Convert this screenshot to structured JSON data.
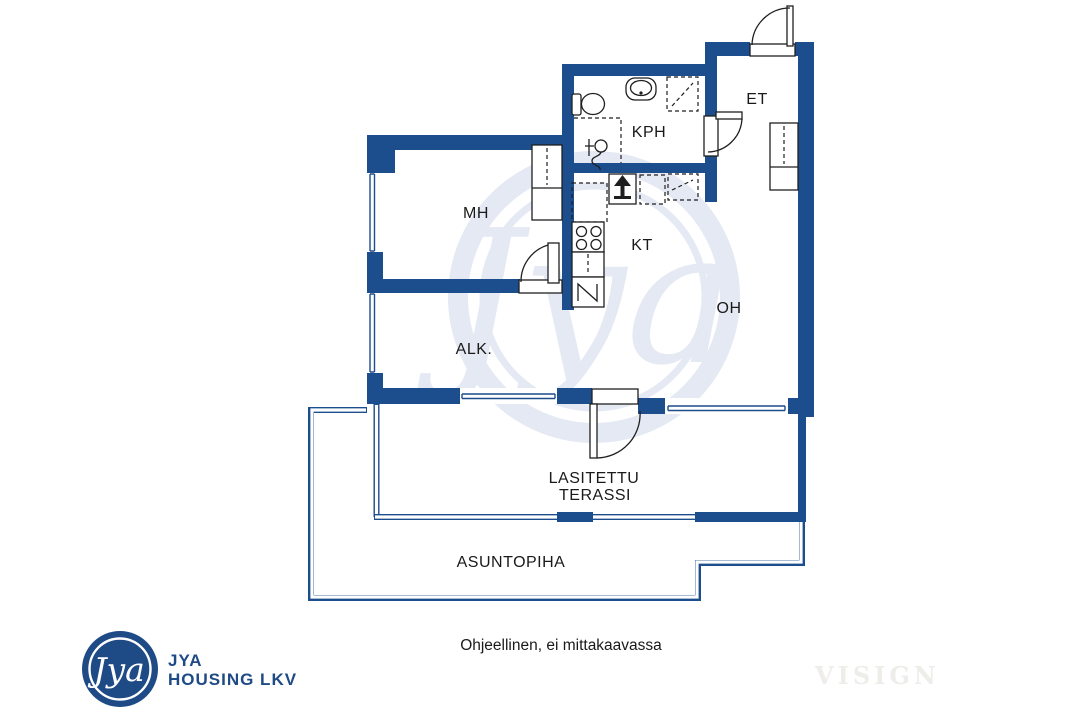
{
  "colors": {
    "wall_navy": "#1c4d8c",
    "logo_navy": "#1e4a85",
    "watermark_blue": "#e4e9f3",
    "producer_gray": "#eeedea",
    "line_black": "#1f1f1f"
  },
  "floor_plan": {
    "rooms": [
      {
        "key": "mh",
        "label": "MH"
      },
      {
        "key": "kph",
        "label": "KPH"
      },
      {
        "key": "et",
        "label": "ET"
      },
      {
        "key": "kt",
        "label": "KT"
      },
      {
        "key": "oh",
        "label": "OH"
      },
      {
        "key": "alk",
        "label": "ALK."
      }
    ],
    "terrace": {
      "line1": "LASITETTU",
      "line2": "TERASSI"
    },
    "yard": {
      "label": "ASUNTOPIHA"
    },
    "fixtures": [
      "toilet",
      "bathroom-sink",
      "shower",
      "washing-machine-connection",
      "kitchen-sink",
      "stove",
      "fridge",
      "counter",
      "wardrobe-mh",
      "wardrobe-et"
    ]
  },
  "watermark": {
    "monogram": "Jya"
  },
  "footer": {
    "logo": {
      "monogram": "Jya",
      "name_line1": "JYA",
      "name_line2": "HOUSING LKV"
    },
    "disclaimer": "Ohjeellinen, ei mittakaavassa",
    "producer_watermark": "VISIGN"
  }
}
